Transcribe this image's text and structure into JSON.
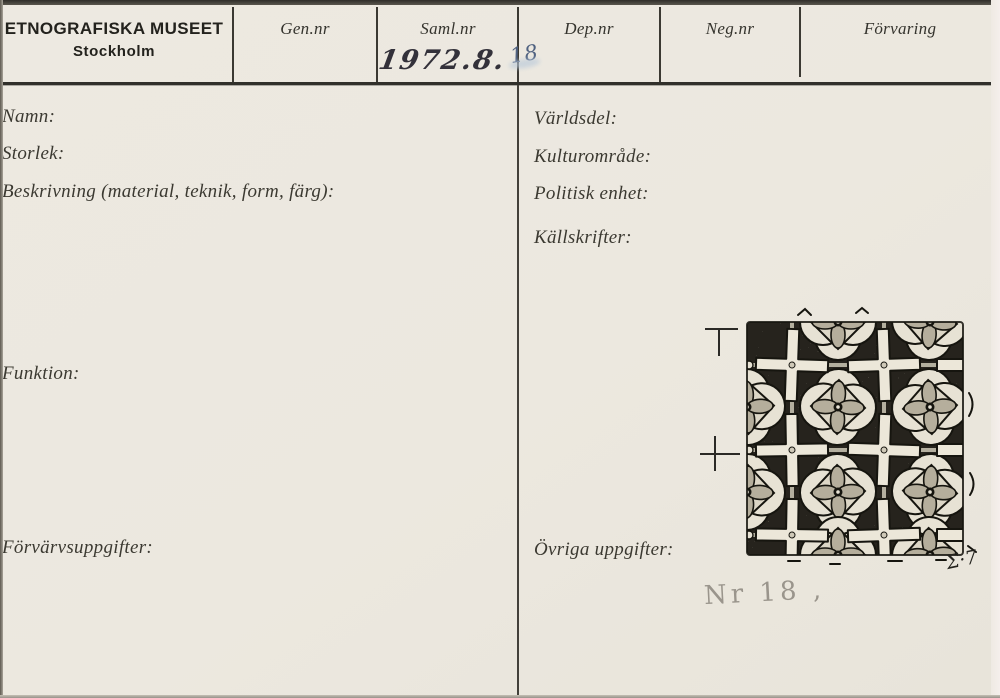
{
  "card": {
    "institution_name": "ETNOGRAFISKA MUSEET",
    "institution_city": "Stockholm",
    "header_columns": [
      "Gen.nr",
      "Saml.nr",
      "Dep.nr",
      "Neg.nr",
      "Förvaring"
    ],
    "fields_left": [
      "Namn:",
      "Storlek:",
      "Beskrivning (material, teknik, form, färg):",
      "Funktion:",
      "Förvärvsuppgifter:"
    ],
    "fields_right": [
      "Världsdel:",
      "Kulturområde:",
      "Politisk enhet:",
      "Källskrifter:",
      "Övriga uppgifter:"
    ],
    "handwritten": {
      "saml_nr_ink": "1972.8.",
      "saml_nr_pencil": "18",
      "object_note_pencil": "Nr 18 ,",
      "drawing_signature": "Σ·7"
    },
    "drawing": {
      "description": "Ink drawing of a repeating tile pattern: quatrefoil rosette medallions alternating with light crosses on a dark stippled ground, vertical dimension marks at left"
    },
    "colors": {
      "card_background": "#ece8df",
      "rule_line": "#3b3933",
      "printed_text": "#3b3931",
      "handwriting_ink": "#33313a",
      "pencil_blue": "#4f6180",
      "pencil_gray": "#9a958c",
      "drawing_ink": "#16150f"
    }
  }
}
